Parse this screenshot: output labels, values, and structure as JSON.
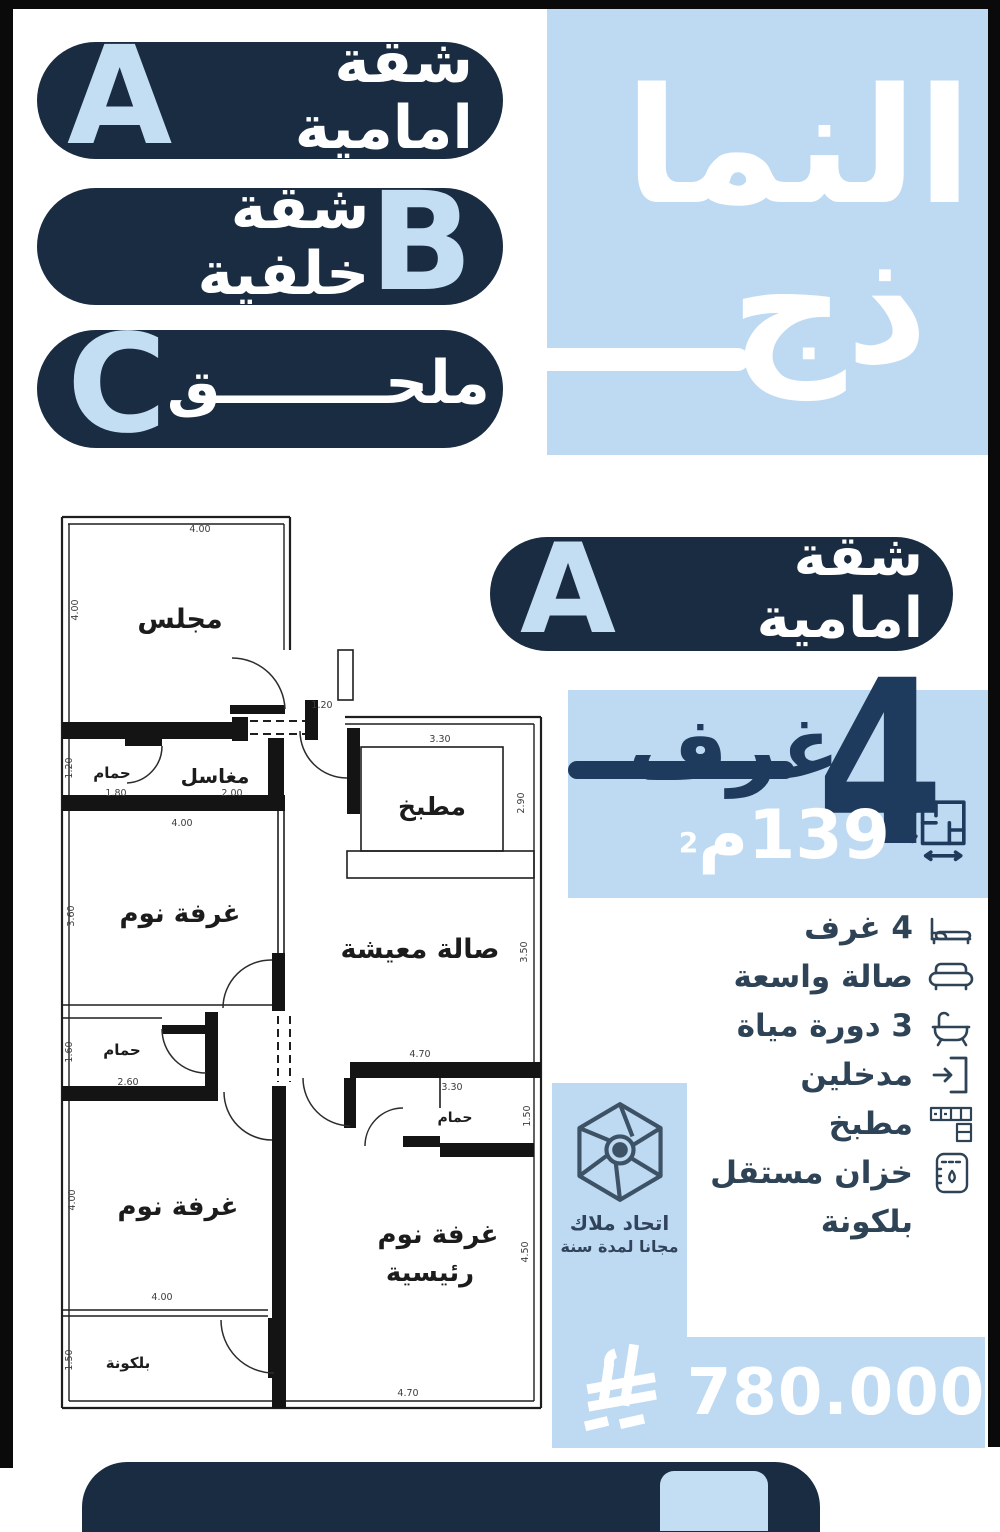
{
  "colors": {
    "navy": "#1a2c42",
    "light_blue": "#bedaf2",
    "stat_ink": "#1e3a5c",
    "feature_ink": "#2e4356",
    "white": "#ffffff"
  },
  "header": {
    "title_line1": "النما",
    "title_line2": "ذج"
  },
  "legend": [
    {
      "letter": "A",
      "label": "شقة امامية"
    },
    {
      "letter": "B",
      "label": "شقة خلفية"
    },
    {
      "letter": "C",
      "label": "ملحــــــــق"
    }
  ],
  "unit": {
    "badge_letter": "A",
    "badge_label": "شقة امامية",
    "rooms_number": "4",
    "rooms_word": "غرف",
    "area_value": "139",
    "area_unit": "م",
    "area_exponent": "2"
  },
  "features": [
    {
      "icon": "bed-icon",
      "label": "4 غرف"
    },
    {
      "icon": "sofa-icon",
      "label": "صالة واسعة"
    },
    {
      "icon": "bathtub-icon",
      "label": "3 دورة مياة"
    },
    {
      "icon": "entrance-icon",
      "label": "مدخلين"
    },
    {
      "icon": "kitchen-icon",
      "label": "مطبخ"
    },
    {
      "icon": "tank-icon",
      "label": "خزان مستقل"
    },
    {
      "icon": "none",
      "label": "بلكونة"
    }
  ],
  "logo": {
    "name_line1": "اتحاد ملاك",
    "name_line2": "مجانا لمدة سنة"
  },
  "price": {
    "amount": "780.000",
    "currency_icon": "saudi-riyal-symbol"
  },
  "floorplan": {
    "rooms": [
      {
        "label": "مجلس",
        "x": 180,
        "y": 628,
        "size": 27
      },
      {
        "label": "حمام",
        "x": 112,
        "y": 778,
        "size": 15
      },
      {
        "label": "مغاسل",
        "x": 215,
        "y": 783,
        "size": 20
      },
      {
        "label": "مطبخ",
        "x": 432,
        "y": 815,
        "size": 25
      },
      {
        "label": "غرفة نوم",
        "x": 180,
        "y": 922,
        "size": 26
      },
      {
        "label": "صالة معيشة",
        "x": 420,
        "y": 958,
        "size": 27
      },
      {
        "label": "حمام",
        "x": 122,
        "y": 1055,
        "size": 15
      },
      {
        "label": "حمام",
        "x": 455,
        "y": 1122,
        "size": 14
      },
      {
        "label": "غرفة نوم",
        "x": 178,
        "y": 1215,
        "size": 26
      },
      {
        "label": "غرفة نوم",
        "x": 438,
        "y": 1243,
        "size": 26
      },
      {
        "label": "رئيسية",
        "x": 430,
        "y": 1281,
        "size": 26
      },
      {
        "label": "بلكونة",
        "x": 128,
        "y": 1368,
        "size": 15
      }
    ],
    "dimensions": [
      {
        "text": "4.00",
        "x": 200,
        "y": 532,
        "rot": false
      },
      {
        "text": "4.00",
        "x": 78,
        "y": 610,
        "rot": true
      },
      {
        "text": "1.20",
        "x": 322,
        "y": 708,
        "rot": false
      },
      {
        "text": "3.30",
        "x": 440,
        "y": 742,
        "rot": false
      },
      {
        "text": "2.90",
        "x": 524,
        "y": 803,
        "rot": true
      },
      {
        "text": "1.20",
        "x": 72,
        "y": 768,
        "rot": true
      },
      {
        "text": "1.80",
        "x": 116,
        "y": 796,
        "rot": false
      },
      {
        "text": "2.00",
        "x": 232,
        "y": 796,
        "rot": false
      },
      {
        "text": "4.00",
        "x": 182,
        "y": 826,
        "rot": false
      },
      {
        "text": "3.60",
        "x": 74,
        "y": 916,
        "rot": true
      },
      {
        "text": "3.50",
        "x": 527,
        "y": 952,
        "rot": true
      },
      {
        "text": "1.60",
        "x": 72,
        "y": 1052,
        "rot": true
      },
      {
        "text": "2.60",
        "x": 128,
        "y": 1085,
        "rot": false
      },
      {
        "text": "4.70",
        "x": 420,
        "y": 1057,
        "rot": false
      },
      {
        "text": "3.30",
        "x": 452,
        "y": 1090,
        "rot": false
      },
      {
        "text": "1.50",
        "x": 530,
        "y": 1116,
        "rot": true
      },
      {
        "text": "4.00",
        "x": 75,
        "y": 1200,
        "rot": true
      },
      {
        "text": "4.00",
        "x": 162,
        "y": 1300,
        "rot": false
      },
      {
        "text": "4.50",
        "x": 528,
        "y": 1252,
        "rot": true
      },
      {
        "text": "1.50",
        "x": 72,
        "y": 1360,
        "rot": true
      },
      {
        "text": "4.70",
        "x": 408,
        "y": 1396,
        "rot": false
      }
    ]
  },
  "footer": {
    "partial_letter": "B"
  }
}
